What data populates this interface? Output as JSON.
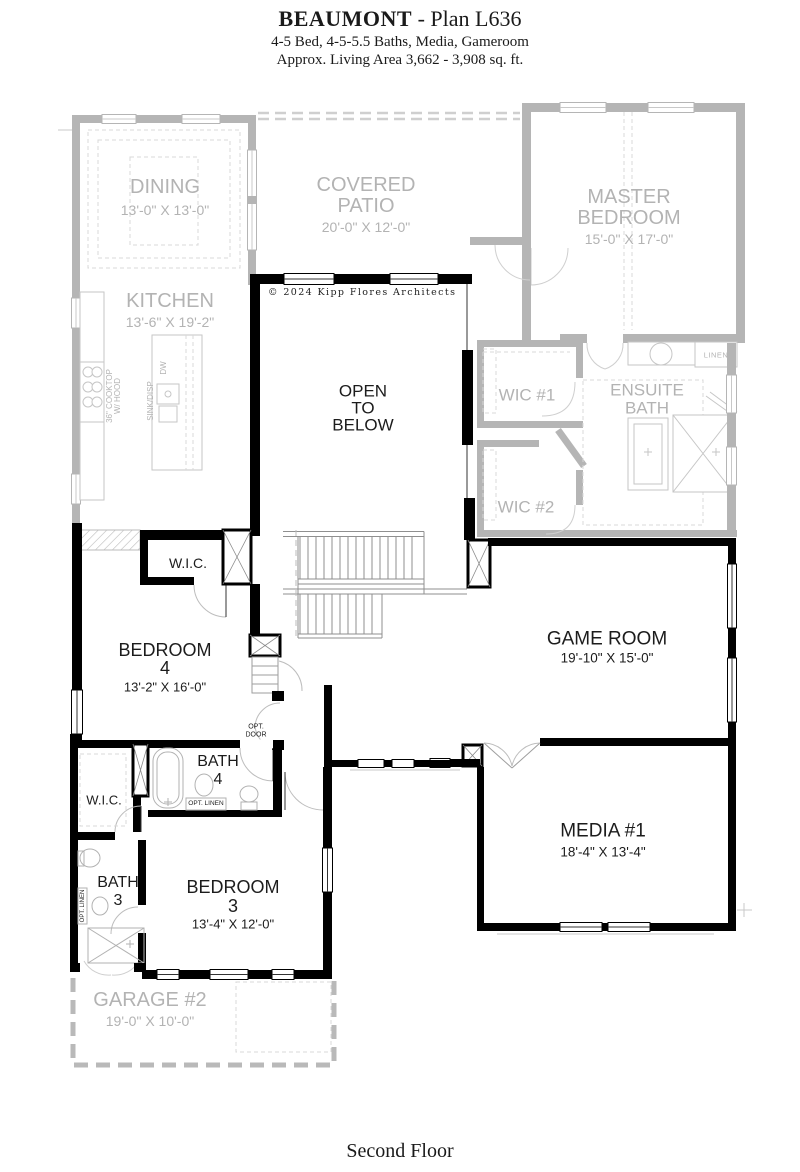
{
  "header": {
    "title_bold": "BEAUMONT",
    "title_rest": " - Plan L636",
    "subtitle1": "4-5 Bed, 4-5-5.5 Baths, Media, Gameroom",
    "subtitle2": "Approx. Living Area 3,662 - 3,908 sq. ft."
  },
  "footer": {
    "label": "Second Floor"
  },
  "copyright": "© 2024 Kipp Flores Architects",
  "colors": {
    "wall_black": "#000000",
    "wall_gray": "#b5b5b5",
    "label_gray": "#b3b3b3",
    "label_black": "#1c1c1c"
  },
  "rooms": {
    "dining": {
      "name": "DINING",
      "dims": "13'-0\" X 13'-0\""
    },
    "kitchen": {
      "name": "KITCHEN",
      "dims": "13'-6\" X 19'-2\""
    },
    "covered_patio": {
      "line1": "COVERED",
      "line2": "PATIO",
      "dims": "20'-0\" X 12'-0\""
    },
    "master_bedroom": {
      "line1": "MASTER",
      "line2": "BEDROOM",
      "dims": "15'-0\" X 17'-0\""
    },
    "wic1": {
      "name": "WIC #1"
    },
    "wic2": {
      "name": "WIC #2"
    },
    "ensuite_bath": {
      "line1": "ENSUITE",
      "line2": "BATH"
    },
    "linen": {
      "name": "LINEN"
    },
    "open_below": {
      "line1": "OPEN",
      "line2": "TO",
      "line3": "BELOW"
    },
    "wic_bed4": {
      "name": "W.I.C."
    },
    "bedroom4": {
      "name": "BEDROOM",
      "number": "4",
      "dims": "13'-2\" X 16'-0\""
    },
    "game_room": {
      "name": "GAME ROOM",
      "dims": "19'-10\" X 15'-0\""
    },
    "bath4": {
      "name": "BATH",
      "number": "4"
    },
    "wic_bed3": {
      "name": "W.I.C."
    },
    "bath3": {
      "name": "BATH",
      "number": "3"
    },
    "bedroom3": {
      "name": "BEDROOM",
      "number": "3",
      "dims": "13'-4\" X 12'-0\""
    },
    "media1": {
      "name": "MEDIA #1",
      "dims": "18'-4\" X 13'-4\""
    },
    "garage2": {
      "name": "GARAGE #2",
      "dims": "19'-0\" X 10'-0\""
    }
  },
  "annotations": {
    "opt_door_line1": "OPT.",
    "opt_door_line2": "DOOR",
    "opt_linen": "OPT. LINEN",
    "opt_linen_vertical": "OPT. LINEN",
    "cooktop_line1": "36\" COOKTOP",
    "cooktop_line2": "W/ HOOD",
    "sink_disp": "SINK/DISP",
    "dw": "DW"
  }
}
